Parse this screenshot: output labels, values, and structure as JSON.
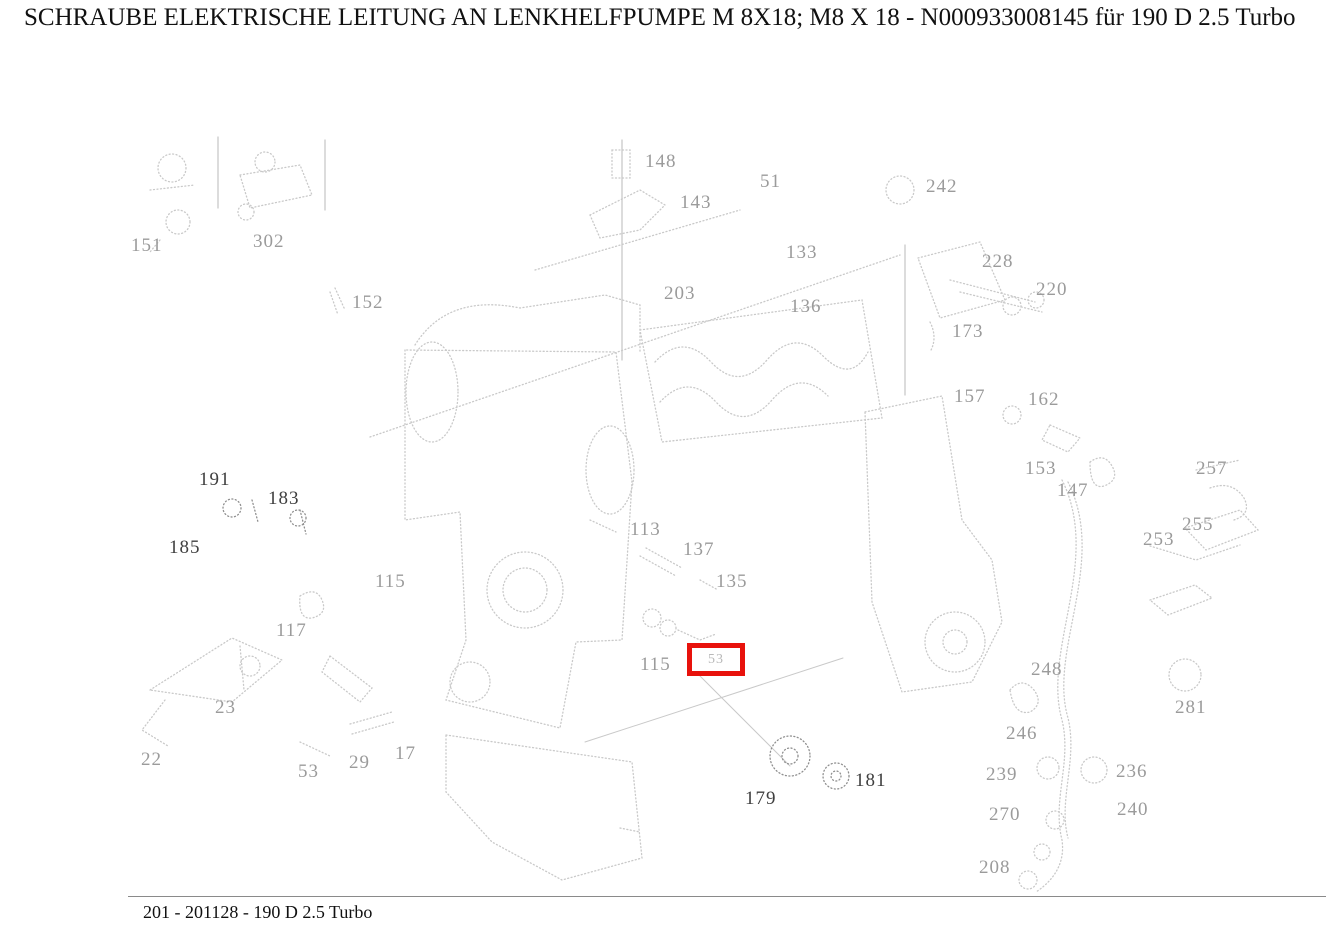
{
  "header": {
    "title": "SCHRAUBE ELEKTRISCHE LEITUNG AN LENKHELFPUMPE M 8X18; M8 X 18 - N000933008145 für 190 D 2.5 Turbo"
  },
  "footer": {
    "caption": "201 - 201128 - 190 D 2.5 Turbo"
  },
  "colors": {
    "highlight": "#e8120c",
    "label_faint": "#9b9b9b",
    "label_dark": "#3f3f3f",
    "line_art": "#c9c9c9",
    "line_art_dark": "#8f8f8f"
  },
  "diagram": {
    "highlight": {
      "label": "53",
      "x": 687,
      "y": 643,
      "width": 58,
      "height": 33,
      "border": 5
    },
    "labels": [
      {
        "text": "151",
        "x": 131,
        "y": 236,
        "tone": "faint"
      },
      {
        "text": "302",
        "x": 253,
        "y": 232,
        "tone": "faint"
      },
      {
        "text": "152",
        "x": 352,
        "y": 293,
        "tone": "faint"
      },
      {
        "text": "148",
        "x": 645,
        "y": 152,
        "tone": "faint"
      },
      {
        "text": "143",
        "x": 680,
        "y": 193,
        "tone": "faint"
      },
      {
        "text": "51",
        "x": 760,
        "y": 172,
        "tone": "faint"
      },
      {
        "text": "203",
        "x": 664,
        "y": 284,
        "tone": "faint"
      },
      {
        "text": "133",
        "x": 786,
        "y": 243,
        "tone": "faint"
      },
      {
        "text": "136",
        "x": 790,
        "y": 297,
        "tone": "faint"
      },
      {
        "text": "242",
        "x": 926,
        "y": 177,
        "tone": "faint"
      },
      {
        "text": "228",
        "x": 982,
        "y": 252,
        "tone": "faint"
      },
      {
        "text": "220",
        "x": 1036,
        "y": 280,
        "tone": "faint"
      },
      {
        "text": "173",
        "x": 952,
        "y": 322,
        "tone": "faint"
      },
      {
        "text": "157",
        "x": 954,
        "y": 387,
        "tone": "faint"
      },
      {
        "text": "162",
        "x": 1028,
        "y": 390,
        "tone": "faint"
      },
      {
        "text": "153",
        "x": 1025,
        "y": 459,
        "tone": "faint"
      },
      {
        "text": "147",
        "x": 1057,
        "y": 481,
        "tone": "faint"
      },
      {
        "text": "257",
        "x": 1196,
        "y": 459,
        "tone": "faint"
      },
      {
        "text": "255",
        "x": 1182,
        "y": 515,
        "tone": "faint"
      },
      {
        "text": "253",
        "x": 1143,
        "y": 530,
        "tone": "faint"
      },
      {
        "text": "191",
        "x": 199,
        "y": 470,
        "tone": "dark"
      },
      {
        "text": "183",
        "x": 268,
        "y": 489,
        "tone": "dark"
      },
      {
        "text": "185",
        "x": 169,
        "y": 538,
        "tone": "dark"
      },
      {
        "text": "115",
        "x": 375,
        "y": 572,
        "tone": "faint"
      },
      {
        "text": "113",
        "x": 630,
        "y": 520,
        "tone": "faint"
      },
      {
        "text": "137",
        "x": 683,
        "y": 540,
        "tone": "faint"
      },
      {
        "text": "135",
        "x": 716,
        "y": 572,
        "tone": "faint"
      },
      {
        "text": "117",
        "x": 276,
        "y": 621,
        "tone": "faint"
      },
      {
        "text": "23",
        "x": 215,
        "y": 698,
        "tone": "faint"
      },
      {
        "text": "22",
        "x": 141,
        "y": 750,
        "tone": "faint"
      },
      {
        "text": "53",
        "x": 298,
        "y": 762,
        "tone": "faint"
      },
      {
        "text": "29",
        "x": 349,
        "y": 753,
        "tone": "faint"
      },
      {
        "text": "17",
        "x": 395,
        "y": 744,
        "tone": "faint"
      },
      {
        "text": "115",
        "x": 640,
        "y": 655,
        "tone": "faint"
      },
      {
        "text": "179",
        "x": 745,
        "y": 789,
        "tone": "dark"
      },
      {
        "text": "181",
        "x": 855,
        "y": 771,
        "tone": "dark"
      },
      {
        "text": "248",
        "x": 1031,
        "y": 660,
        "tone": "faint"
      },
      {
        "text": "281",
        "x": 1175,
        "y": 698,
        "tone": "faint"
      },
      {
        "text": "246",
        "x": 1006,
        "y": 724,
        "tone": "faint"
      },
      {
        "text": "239",
        "x": 986,
        "y": 765,
        "tone": "faint"
      },
      {
        "text": "236",
        "x": 1116,
        "y": 762,
        "tone": "faint"
      },
      {
        "text": "270",
        "x": 989,
        "y": 805,
        "tone": "faint"
      },
      {
        "text": "240",
        "x": 1117,
        "y": 800,
        "tone": "faint"
      },
      {
        "text": "208",
        "x": 979,
        "y": 858,
        "tone": "faint"
      }
    ]
  }
}
